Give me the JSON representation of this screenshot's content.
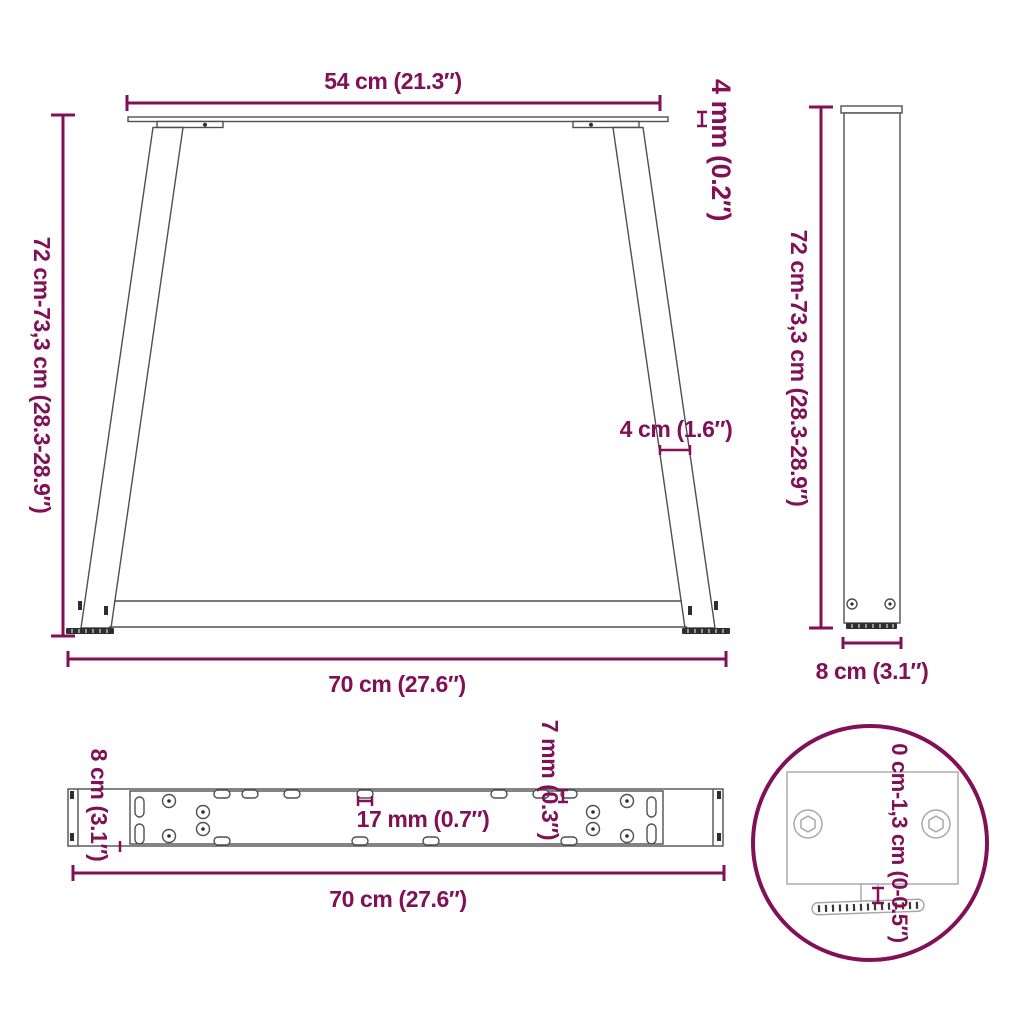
{
  "colors": {
    "accent": "#811057",
    "drawing_line": "#4f4f4f",
    "detail_line": "#a6a6a6",
    "foot_dark": "#2e2e2e",
    "background": "#ffffff"
  },
  "views": {
    "front": {
      "name": "table-leg-front-view",
      "labels": {
        "top_width": "54 cm (21.3″)",
        "plate_thickness": "4 mm (0.2″)",
        "height": "72 cm-73,3 cm (28.3-28.9″)",
        "leg_width": "4 cm (1.6″)",
        "bottom_width": "70 cm (27.6″)"
      }
    },
    "side": {
      "name": "table-leg-side-view",
      "labels": {
        "height": "72 cm-73,3 cm (28.3-28.9″)",
        "depth": "8 cm (3.1″)"
      }
    },
    "beam": {
      "name": "table-leg-top-view",
      "labels": {
        "depth": "8 cm (3.1″)",
        "hole_spacing": "17 mm (0.7″)",
        "hole_diameter": "7 mm (0.3″)",
        "length": "70 cm (27.6″)"
      }
    },
    "detail": {
      "name": "adjustable-foot-detail",
      "labels": {
        "adjustment_range": "0 cm-1,3 cm (0-0.5″)"
      }
    }
  }
}
